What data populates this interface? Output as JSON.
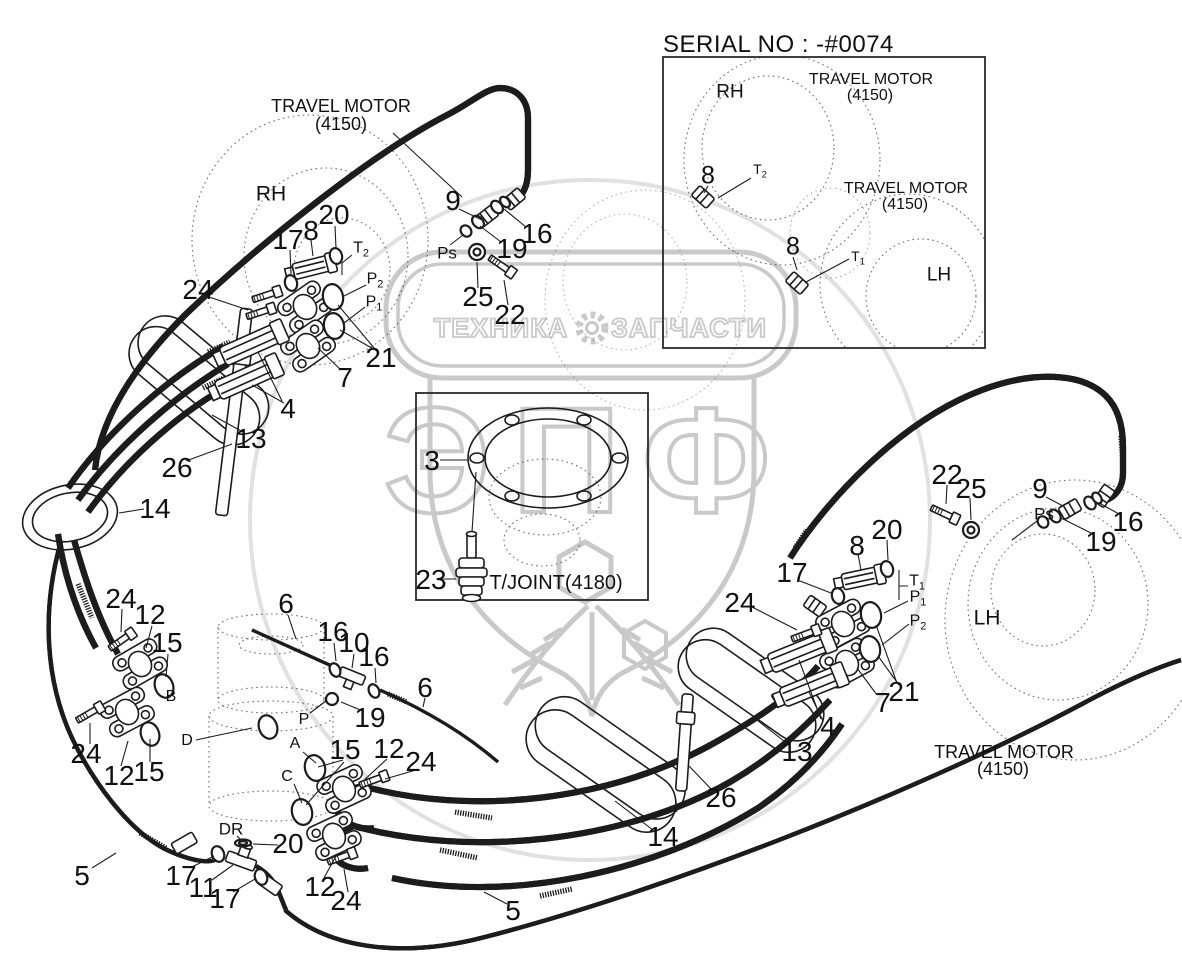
{
  "page": {
    "serial_no": "SERIAL NO : -#0074"
  },
  "watermark": {
    "left_text": "ТЕХНИКА",
    "right_text": "ЗАПЧАСТИ",
    "logo_text": "ЭПФ",
    "gear_icon": "gear",
    "color": "#c9c9c9"
  },
  "colors": {
    "line": "#1c1c1c",
    "background": "#ffffff"
  },
  "callouts": [
    {
      "t": "TRAVEL MOTOR",
      "x": 341,
      "y": 106,
      "fs": 18
    },
    {
      "t": "(4150)",
      "x": 341,
      "y": 124,
      "fs": 18
    },
    {
      "t": "RH",
      "x": 271,
      "y": 194,
      "fs": 21
    },
    {
      "t": "20",
      "x": 334,
      "y": 215
    },
    {
      "t": "8",
      "x": 311,
      "y": 231
    },
    {
      "t": "17",
      "x": 288,
      "y": 240
    },
    {
      "t": "24",
      "x": 198,
      "y": 290
    },
    {
      "t": "9",
      "x": 453,
      "y": 201
    },
    {
      "t": "16",
      "x": 537,
      "y": 234
    },
    {
      "t": "19",
      "x": 512,
      "y": 249
    },
    {
      "t": "Ps",
      "x": 447,
      "y": 253,
      "fs": 17
    },
    {
      "t": "25",
      "x": 478,
      "y": 297
    },
    {
      "t": "22",
      "x": 510,
      "y": 315
    },
    {
      "t": "T",
      "sub": "2",
      "x": 361,
      "y": 250,
      "fs": 16
    },
    {
      "t": "P",
      "sub": "2",
      "x": 375,
      "y": 281,
      "fs": 16
    },
    {
      "t": "P",
      "sub": "1",
      "x": 374,
      "y": 304,
      "fs": 16
    },
    {
      "t": "21",
      "x": 381,
      "y": 358
    },
    {
      "t": "7",
      "x": 345,
      "y": 378
    },
    {
      "t": "4",
      "x": 288,
      "y": 409
    },
    {
      "t": "13",
      "x": 251,
      "y": 439
    },
    {
      "t": "26",
      "x": 177,
      "y": 468
    },
    {
      "t": "14",
      "x": 155,
      "y": 509
    },
    {
      "t": "3",
      "x": 432,
      "y": 461
    },
    {
      "t": "23",
      "x": 431,
      "y": 580
    },
    {
      "t": "T/JOINT(4180)",
      "x": 556,
      "y": 583,
      "fs": 20
    },
    {
      "t": "22",
      "x": 947,
      "y": 475
    },
    {
      "t": "25",
      "x": 971,
      "y": 489
    },
    {
      "t": "9",
      "x": 1040,
      "y": 489
    },
    {
      "t": "Ps",
      "x": 1044,
      "y": 514,
      "fs": 17
    },
    {
      "t": "16",
      "x": 1128,
      "y": 522
    },
    {
      "t": "19",
      "x": 1101,
      "y": 542
    },
    {
      "t": "20",
      "x": 887,
      "y": 530
    },
    {
      "t": "8",
      "x": 857,
      "y": 546
    },
    {
      "t": "17",
      "x": 792,
      "y": 573
    },
    {
      "t": "T",
      "sub": "1",
      "x": 917,
      "y": 583,
      "fs": 16
    },
    {
      "t": "P",
      "sub": "1",
      "x": 918,
      "y": 599,
      "fs": 16
    },
    {
      "t": "P",
      "sub": "2",
      "x": 918,
      "y": 623,
      "fs": 16
    },
    {
      "t": "24",
      "x": 740,
      "y": 603
    },
    {
      "t": "LH",
      "x": 987,
      "y": 618,
      "fs": 21
    },
    {
      "t": "21",
      "x": 904,
      "y": 692
    },
    {
      "t": "7",
      "x": 883,
      "y": 703
    },
    {
      "t": "4",
      "x": 828,
      "y": 727
    },
    {
      "t": "13",
      "x": 797,
      "y": 752
    },
    {
      "t": "26",
      "x": 721,
      "y": 798
    },
    {
      "t": "14",
      "x": 663,
      "y": 837
    },
    {
      "t": "TRAVEL MOTOR",
      "x": 1004,
      "y": 752,
      "fs": 18
    },
    {
      "t": "(4150)",
      "x": 1003,
      "y": 769,
      "fs": 18
    },
    {
      "t": "24",
      "x": 121,
      "y": 599
    },
    {
      "t": "12",
      "x": 150,
      "y": 615
    },
    {
      "t": "15",
      "x": 167,
      "y": 643
    },
    {
      "t": "B",
      "x": 171,
      "y": 697,
      "fs": 16
    },
    {
      "t": "6",
      "x": 286,
      "y": 604
    },
    {
      "t": "16",
      "x": 333,
      "y": 632
    },
    {
      "t": "10",
      "x": 354,
      "y": 643
    },
    {
      "t": "16",
      "x": 374,
      "y": 657
    },
    {
      "t": "19",
      "x": 370,
      "y": 718
    },
    {
      "t": "P",
      "x": 304,
      "y": 720,
      "fs": 16
    },
    {
      "t": "A",
      "x": 295,
      "y": 744,
      "fs": 16
    },
    {
      "t": "C",
      "x": 287,
      "y": 777,
      "fs": 16
    },
    {
      "t": "D",
      "x": 187,
      "y": 741,
      "fs": 16
    },
    {
      "t": "24",
      "x": 86,
      "y": 754
    },
    {
      "t": "15",
      "x": 149,
      "y": 772
    },
    {
      "t": "12",
      "x": 119,
      "y": 776
    },
    {
      "t": "15",
      "x": 345,
      "y": 750
    },
    {
      "t": "12",
      "x": 389,
      "y": 749
    },
    {
      "t": "24",
      "x": 421,
      "y": 762
    },
    {
      "t": "6",
      "x": 425,
      "y": 688
    },
    {
      "t": "DR",
      "x": 231,
      "y": 829,
      "fs": 17
    },
    {
      "t": "20",
      "x": 288,
      "y": 844
    },
    {
      "t": "17",
      "x": 181,
      "y": 876
    },
    {
      "t": "11",
      "x": 203,
      "y": 888
    },
    {
      "t": "17",
      "x": 225,
      "y": 899
    },
    {
      "t": "12",
      "x": 320,
      "y": 887
    },
    {
      "t": "24",
      "x": 346,
      "y": 901
    },
    {
      "t": "5",
      "x": 82,
      "y": 876
    },
    {
      "t": "5",
      "x": 513,
      "y": 911
    },
    {
      "t": "RH",
      "x": 730,
      "y": 92,
      "fs": 19
    },
    {
      "t": "TRAVEL MOTOR",
      "x": 871,
      "y": 80,
      "fs": 16
    },
    {
      "t": "(4150)",
      "x": 870,
      "y": 96,
      "fs": 16
    },
    {
      "t": "8",
      "x": 708,
      "y": 176,
      "fs": 25
    },
    {
      "t": "T",
      "sub": "2",
      "x": 760,
      "y": 171,
      "fs": 14
    },
    {
      "t": "TRAVEL MOTOR",
      "x": 906,
      "y": 189,
      "fs": 16
    },
    {
      "t": "(4150)",
      "x": 905,
      "y": 205,
      "fs": 16
    },
    {
      "t": "8",
      "x": 793,
      "y": 247,
      "fs": 25
    },
    {
      "t": "T",
      "sub": "1",
      "x": 858,
      "y": 258,
      "fs": 14
    },
    {
      "t": "LH",
      "x": 939,
      "y": 275,
      "fs": 19
    }
  ]
}
